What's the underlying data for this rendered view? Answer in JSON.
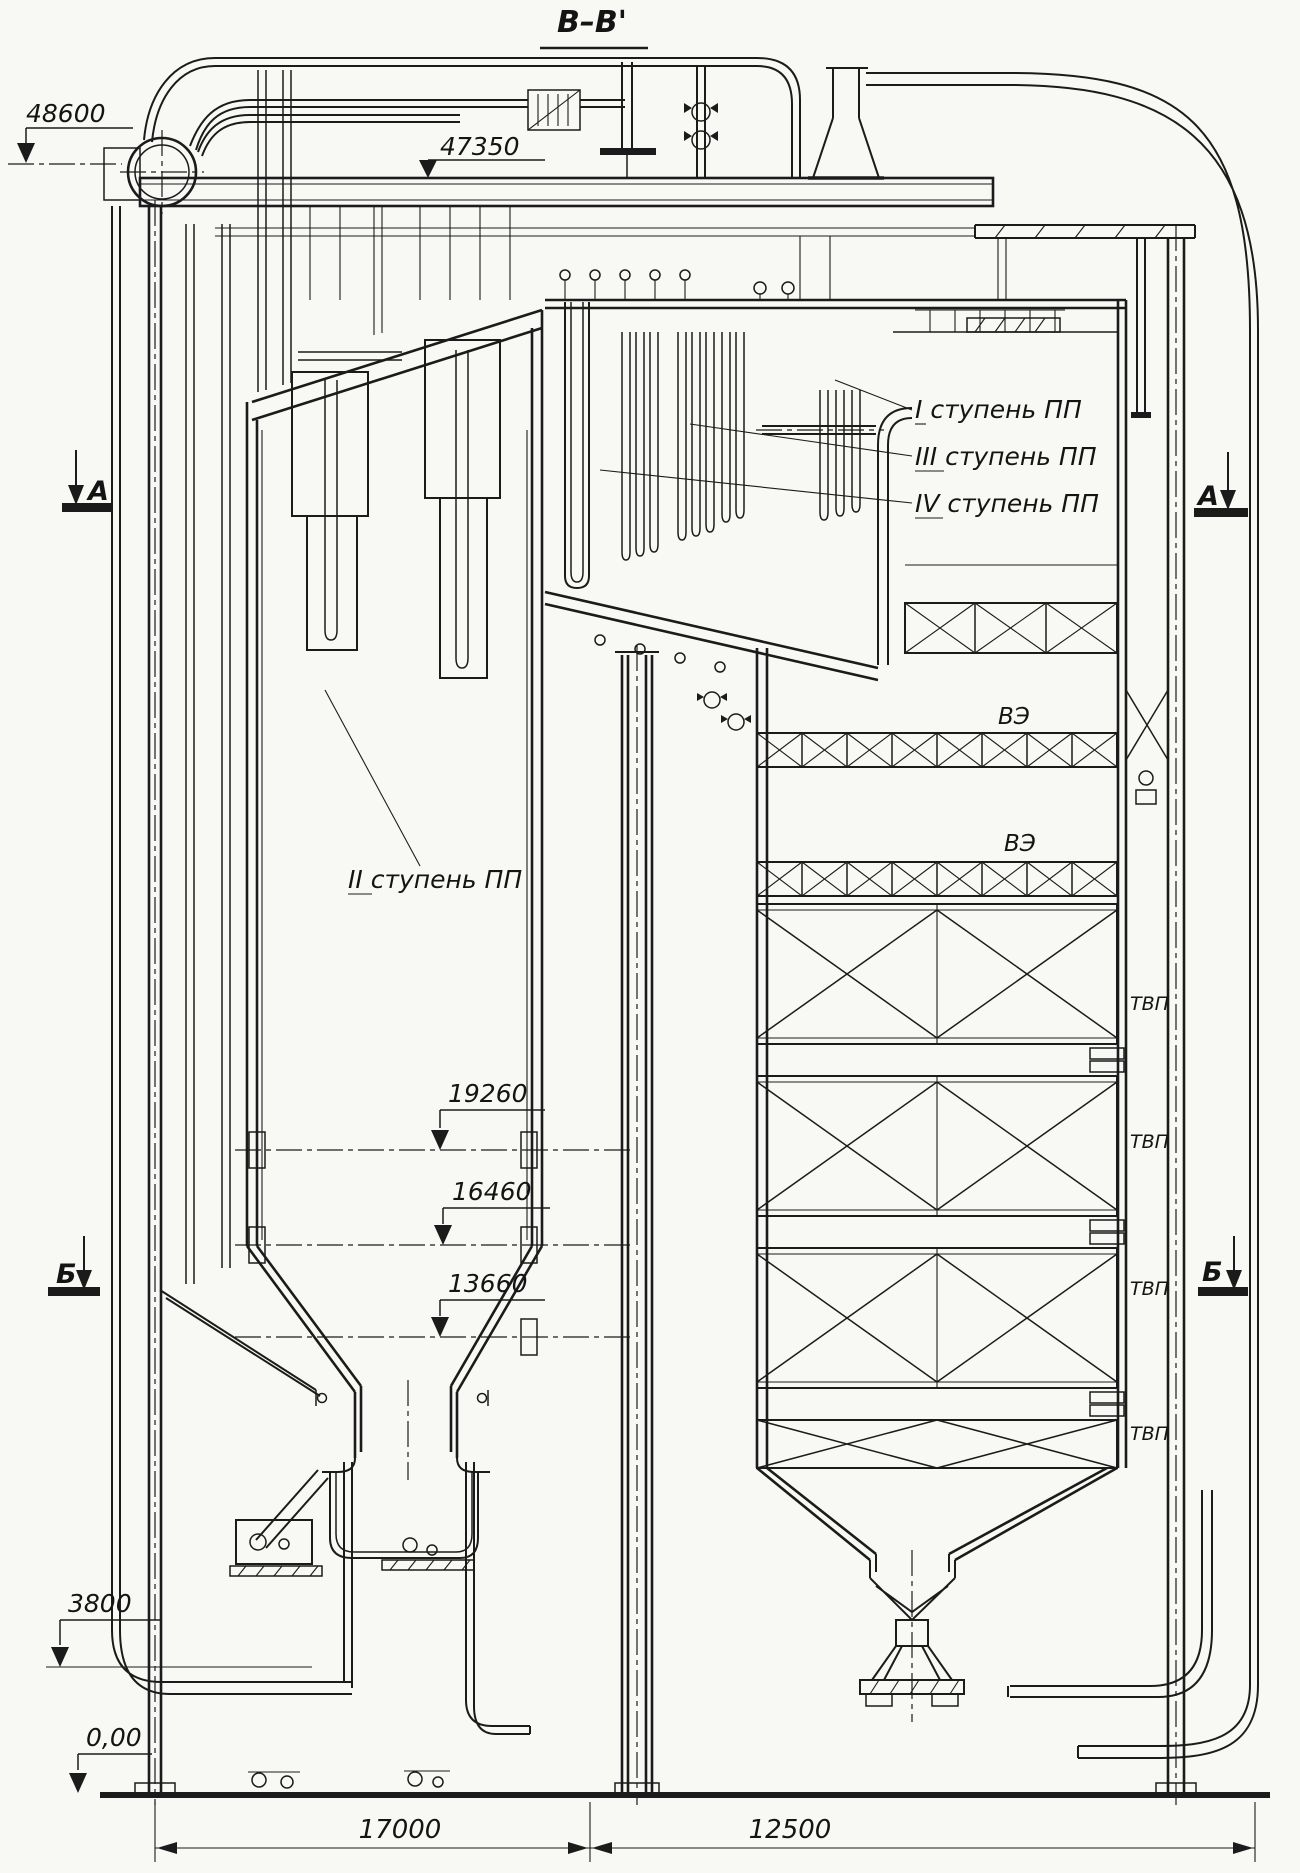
{
  "title": "В–В'",
  "colors": {
    "ink": "#1b1b1b",
    "paper": "#f8f8f5"
  },
  "elevation_marks": {
    "e48600": "48600",
    "e47350": "47350",
    "e19260": "19260",
    "e16460": "16460",
    "e13660": "13660",
    "e3800": "3800",
    "e0": "0,00"
  },
  "superheater_stages": {
    "s1": {
      "numeral": "I",
      "name": " ступень ПП"
    },
    "s2": {
      "numeral": "II",
      "name": " ступень ПП"
    },
    "s3": {
      "numeral": "III",
      "name": " ступень ПП"
    },
    "s4": {
      "numeral": "IV",
      "name": " ступень ПП"
    }
  },
  "economizer_labels": {
    "upper": "ВЭ",
    "lower": "ВЭ"
  },
  "air_heater_labels": {
    "l1": "ТВП",
    "l2": "ТВП",
    "l3": "ТВП",
    "l4": "ТВП"
  },
  "section_markers": {
    "a_left": "А",
    "a_right": "А",
    "b_left": "Б",
    "b_right": "Б"
  },
  "dimensions": {
    "span_left": "17000",
    "span_right": "12500"
  }
}
